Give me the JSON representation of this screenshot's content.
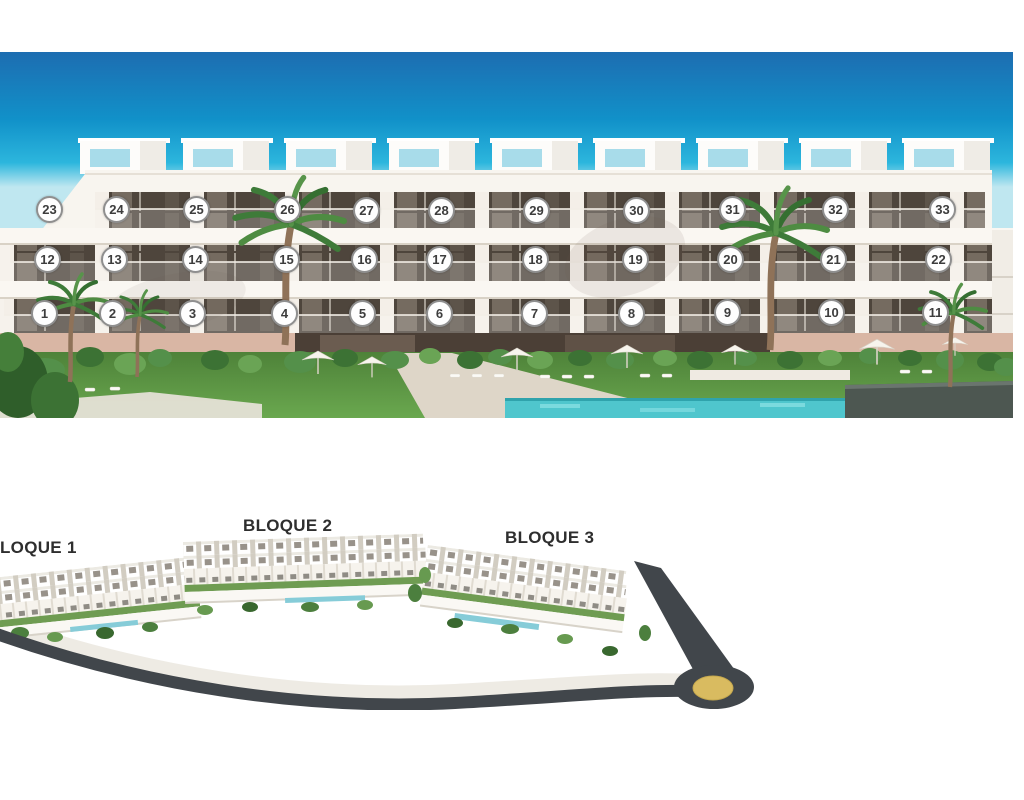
{
  "facade_view": {
    "unit_badges": [
      {
        "label": "1",
        "x": 45,
        "y": 314
      },
      {
        "label": "2",
        "x": 113,
        "y": 314
      },
      {
        "label": "3",
        "x": 193,
        "y": 314
      },
      {
        "label": "4",
        "x": 285,
        "y": 314
      },
      {
        "label": "5",
        "x": 363,
        "y": 314
      },
      {
        "label": "6",
        "x": 440,
        "y": 314
      },
      {
        "label": "7",
        "x": 535,
        "y": 314
      },
      {
        "label": "8",
        "x": 632,
        "y": 314
      },
      {
        "label": "9",
        "x": 728,
        "y": 313
      },
      {
        "label": "10",
        "x": 832,
        "y": 313
      },
      {
        "label": "11",
        "x": 936,
        "y": 313
      },
      {
        "label": "12",
        "x": 48,
        "y": 260
      },
      {
        "label": "13",
        "x": 115,
        "y": 260
      },
      {
        "label": "14",
        "x": 196,
        "y": 260
      },
      {
        "label": "15",
        "x": 287,
        "y": 260
      },
      {
        "label": "16",
        "x": 365,
        "y": 260
      },
      {
        "label": "17",
        "x": 440,
        "y": 260
      },
      {
        "label": "18",
        "x": 536,
        "y": 260
      },
      {
        "label": "19",
        "x": 636,
        "y": 260
      },
      {
        "label": "20",
        "x": 731,
        "y": 260
      },
      {
        "label": "21",
        "x": 834,
        "y": 260
      },
      {
        "label": "22",
        "x": 939,
        "y": 260
      },
      {
        "label": "23",
        "x": 50,
        "y": 210
      },
      {
        "label": "24",
        "x": 117,
        "y": 210
      },
      {
        "label": "25",
        "x": 197,
        "y": 210
      },
      {
        "label": "26",
        "x": 288,
        "y": 210
      },
      {
        "label": "27",
        "x": 367,
        "y": 211
      },
      {
        "label": "28",
        "x": 442,
        "y": 211
      },
      {
        "label": "29",
        "x": 537,
        "y": 211
      },
      {
        "label": "30",
        "x": 637,
        "y": 211
      },
      {
        "label": "31",
        "x": 733,
        "y": 210
      },
      {
        "label": "32",
        "x": 836,
        "y": 210
      },
      {
        "label": "33",
        "x": 943,
        "y": 210
      }
    ]
  },
  "site_plan": {
    "block_labels": [
      {
        "label": "LOQUE 1",
        "x": 0,
        "y": 538
      },
      {
        "label": "BLOQUE 2",
        "x": 243,
        "y": 516
      },
      {
        "label": "BLOQUE 3",
        "x": 505,
        "y": 528
      }
    ]
  },
  "colors": {
    "sky_top": "#1d6db1",
    "sky_horizon": "#bfe7f0",
    "facade_white": "#f6f2ec",
    "window_dark": "#4e453c",
    "base_wall_pink": "#d9b6a4",
    "lawn_green": "#5c9344",
    "pool_turquoise": "#4fc6cd",
    "dark_wall": "#4d5751",
    "road_dark": "#41464b",
    "roundabout_gold": "#d9bb60",
    "badge_border": "#8f8f8f",
    "badge_text": "#3d3d3d",
    "label_text": "#2e2e2e"
  }
}
